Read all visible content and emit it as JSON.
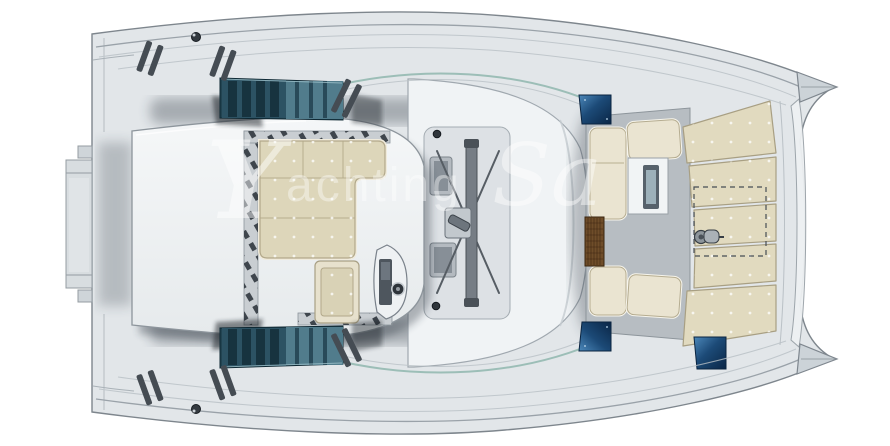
{
  "watermark": {
    "logo_glyph": "Y",
    "word_rest": "achting",
    "word2_visible": "Sa"
  },
  "palette": {
    "bg": "#ffffff",
    "deck": "#e2e6e9",
    "deckline": "#7e868d",
    "roof": "#f0f3f5",
    "cushion": "#ddd6ba",
    "cushionedge": "#b2a88a",
    "cushiontrim": "#f0ebdc",
    "forecushion": "#e1dabf",
    "forecushionedge": "#a89f83",
    "settee": "#eae4d1",
    "glass": "#2c5263",
    "glassdark": "#17333f",
    "hatcha": "#4c88ba",
    "hatchb": "#0a2646",
    "teak": "#6f4d2a",
    "teakline": "#3a250f",
    "metal": "#b9bfc5",
    "metaldark": "#4a5158",
    "floor": "#b7bdc2",
    "shadow": "#1d2630",
    "wm": "rgba(255,255,255,0.48)"
  }
}
